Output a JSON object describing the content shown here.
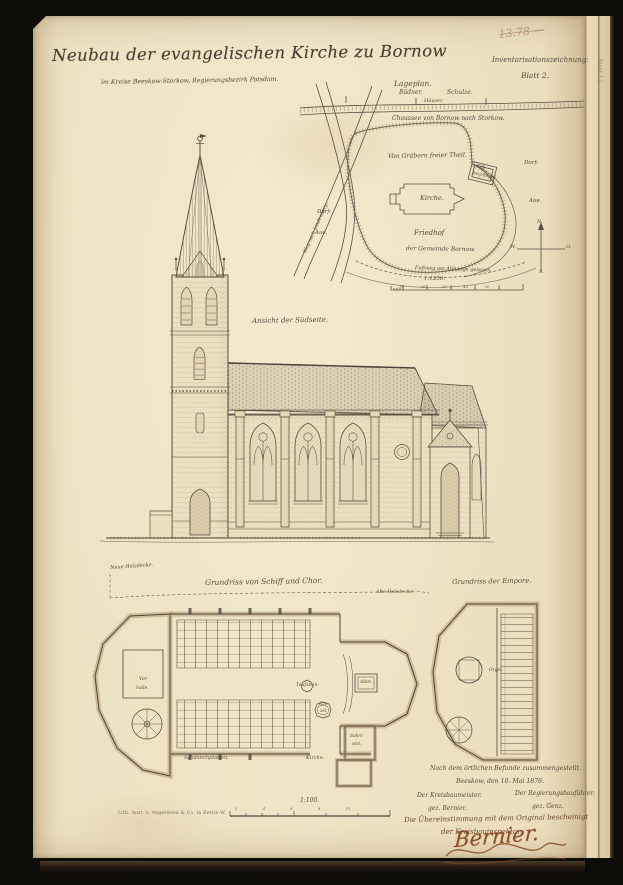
{
  "meta": {
    "pencil_note": "13.78 —",
    "doc_type": "Inventarisationszeichnung:",
    "sheet": "Blatt 2.",
    "edge_note": "Blatt 13."
  },
  "header": {
    "title": "Neubau der evangelischen Kirche zu Bornow",
    "subtitle": "im Kreise Beeskow-Storkow, Regierungsbezirk Potsdam."
  },
  "siteplan": {
    "title": "Lageplan.",
    "budner": "Büdner.",
    "schulze": "Schulze.",
    "haeuser": "Häuser.",
    "road": "Chaussee von Bornow nach Storkow.",
    "free_part": "Von Gräbern freier Theil.",
    "kirche": "Kirche.",
    "erb_line1": "Erb-",
    "erb_line2": "begräbniß.",
    "friedhof": "Friedhof",
    "gemeinde": "der Gemeinde Bornow.",
    "slope": "Fußweg am Abhange gelegen.",
    "weg": "Weg nach Lindenberg.",
    "dorf_left": "Dorf-",
    "aue_left": "Aue.",
    "dorf_right": "Dorf-",
    "aue_right": "Aue.",
    "scale": "1:1250.",
    "scale_ticks": "10 20 30 40 50",
    "compass": {
      "n": "N.",
      "s": "S.",
      "w": "W.",
      "o": "O."
    }
  },
  "elevation": {
    "caption": "Ansicht der Südseite."
  },
  "nave_plan": {
    "title": "Grundriss von Schiff und Chor.",
    "neue_decke": "Neue Holzdecke.",
    "alte_decke": "Alte Holzdecke.",
    "vorhalle_1": "Vor-",
    "vorhalle_2": "halle.",
    "taufstein": "Taufstein.",
    "kanzel_1": "Kan-",
    "kanzel_2": "zel.",
    "altar": "Altar.",
    "sakristei_1": "Sakri-",
    "sakristei_2": "stei.",
    "kirche": "Kirche.",
    "bodenbelag": "Sandsteinplatten.",
    "scale": "1:100.",
    "scale_ticks": "2 4 6 8 10"
  },
  "empore_plan": {
    "title": "Grundriss der Empore.",
    "orgel": "Orgel."
  },
  "footer": {
    "attest_1": "Nach dem örtlichen Befunde zusammengestellt.",
    "attest_2": "Beeskow, den 10. Mai 1876.",
    "role_left": "Der Kreisbaumeister.",
    "sig_left": "gez. Bernier.",
    "role_right": "Der Regierungsbauführer.",
    "sig_right": "gez. Genz.",
    "certify_1": "Die Übereinstimmung mit dem Original bescheinigt",
    "certify_2": "der Kreisbauinspektor.",
    "signature": "Bernier.",
    "print_note": "Lith. Anst. v. Angerstein & Co. in Berlin W."
  },
  "colors": {
    "paper": "#efe3c4",
    "ink": "#50453a",
    "pencil": "#b39a74",
    "signature_ink": "#8d4e28",
    "backdrop": "#0e0c09"
  }
}
